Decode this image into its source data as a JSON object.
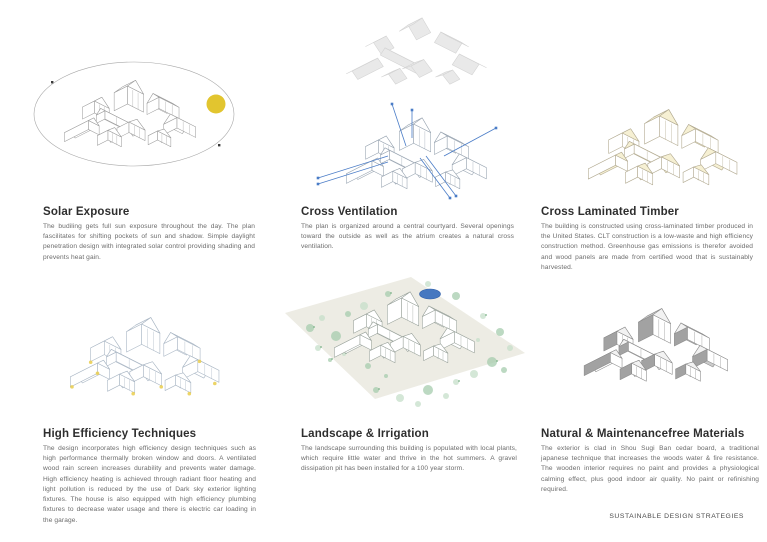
{
  "footer": "SUSTAINABLE DESIGN STRATEGIES",
  "panels": [
    {
      "id": "solar-exposure",
      "diagram": "sun-path-axonometric-diagram",
      "title": "Solar Exposure",
      "body": "The budiling gets full sun exposure throughout the day. The plan fascilitates for shifting pockets of sun and shadow. Simple daylight penetration design with integrated solar control providing shading and prevents heat gain."
    },
    {
      "id": "cross-ventilation",
      "diagram": "exploded-roof-airflow-diagram",
      "title": "Cross Ventilation",
      "body": "The plan is organized around a central courtyard. Several openings toward the outside as well as the atrium creates a natural cross ventilation."
    },
    {
      "id": "cross-laminated-timber",
      "diagram": "clt-highlighted-axonometric-diagram",
      "title": "Cross Laminated Timber",
      "body": "The building is constructed using cross-laminated timber produced in the United States. CLT construction is a low-waste and high efficiency construction method. Greenhouse gas emissions is therefor avoided and wood panels are made from certified wood that is sustainably harvested."
    },
    {
      "id": "high-efficiency-techniques",
      "diagram": "light-fixture-axonometric-diagram",
      "title": "High Efficiency Techniques",
      "body": "The design incorporates high efficiency design techniques such as high performance thermally broken window and doors.  A ventilated wood rain screen increases durability and prevents water damage. High efficiency heating is achieved through radiant floor heating and light pollution is reduced by the use of Dark sky exterior lighting fixtures.  The house is also equipped with high efficiency plumbing fixtures to decrease water usage and there is electric car loading in the garage."
    },
    {
      "id": "landscape-irrigation",
      "diagram": "site-planting-axonometric-diagram",
      "title": "Landscape & Irrigation",
      "body": "The landscape surrounding this building is populated with local plants, which require little water and thrive in the hot summers. A gravel dissipation pit has been installed for a 100 year storm."
    },
    {
      "id": "natural-materials",
      "diagram": "shaded-cladding-axonometric-diagram",
      "title": "Natural & Maintenancefree Materials",
      "body": "The exterior is clad in Shou Sugi Ban cedar board, a traditional japanese technique that increases the woods water & fire resistance. The wooden interior requires no paint and provides a physiological calming effect, plus good indoor air quality. No paint or refinishing required."
    }
  ],
  "colors": {
    "sun_yellow": "#e2c52f",
    "ventilation_blue": "#4a7cc7",
    "clt_cream": "#f6f0d3",
    "clt_line": "#b3ab92",
    "fixture_yellow": "#eacf55",
    "efficiency_line": "#a9b6c4",
    "radiant_blue": "#cfdfee",
    "landscape_green": "#a5ccae",
    "landscape_green_light": "#c6dfca",
    "ground_beige": "#edece4",
    "pond_blue": "#4678c0",
    "line_grey": "#9b9b9b",
    "exploded_roof": "#e9e9e9",
    "exploded_roof_line": "#d2d2d2",
    "dark_wall": "#a2a2a2",
    "roof_grey": "#cbcbcb",
    "dark_line": "#8c8c8c"
  }
}
